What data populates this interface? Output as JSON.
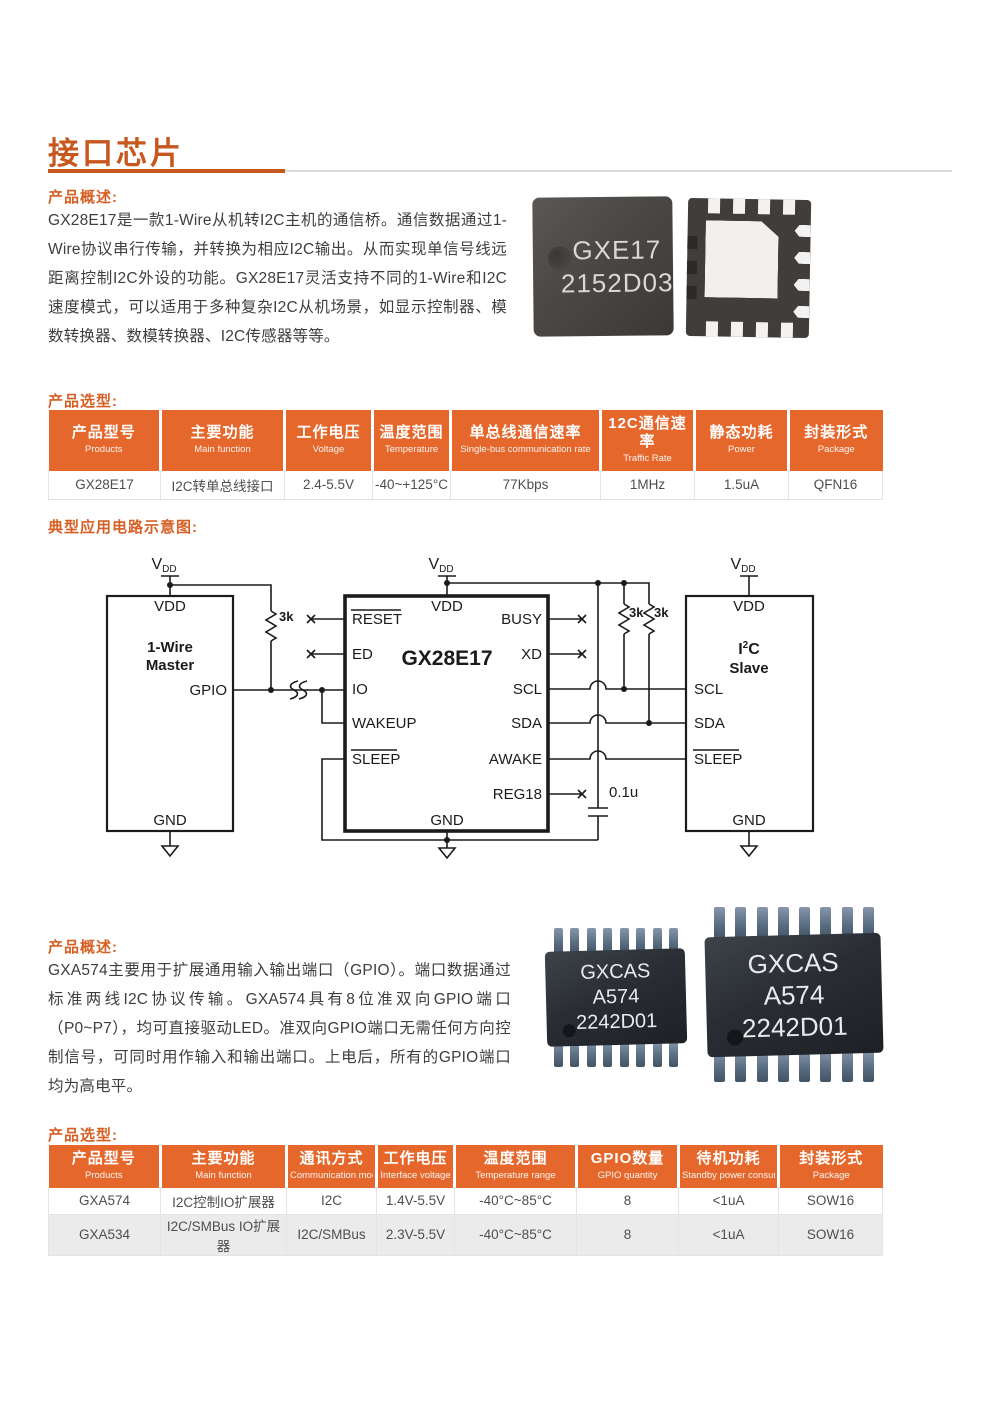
{
  "page": {
    "title": "接口芯片",
    "accent_color": "#c8571e",
    "table_header_color": "#e5672b"
  },
  "section1": {
    "overview_label": "产品概述:",
    "overview_text": "GX28E17是一款1-Wire从机转I2C主机的通信桥。通信数据通过1-Wire协议串行传输，并转换为相应I2C输出。从而实现单信号线远距离控制I2C外设的功能。GX28E17灵活支持不同的1-Wire和I2C速度模式，可以适用于多种复杂I2C从机场景，如显示控制器、模数转换器、数模转换器、I2C传感器等等。",
    "selection_label": "产品选型:",
    "chip_marking": {
      "line1": "GXE17",
      "line2": "2152D03"
    }
  },
  "table1": {
    "headers": [
      [
        "产品型号",
        "Products"
      ],
      [
        "主要功能",
        "Main function"
      ],
      [
        "工作电压",
        "Voltage"
      ],
      [
        "温度范围",
        "Temperature"
      ],
      [
        "单总线通信速率",
        "Single-bus communication rate"
      ],
      [
        "12C通信速率",
        "Traffic Rate"
      ],
      [
        "静态功耗",
        "Power"
      ],
      [
        "封装形式",
        "Package"
      ]
    ],
    "rows": [
      [
        "GX28E17",
        "I2C转单总线接口",
        "2.4-5.5V",
        "-40~+125°C",
        "77Kbps",
        "1MHz",
        "1.5uA",
        "QFN16"
      ]
    ]
  },
  "diagram": {
    "label": "典型应用电路示意图:",
    "vdd_symbol": {
      "main": "V",
      "sub": "DD"
    },
    "master": {
      "vdd": "VDD",
      "name1": "1-Wire",
      "name2": "Master",
      "gpio": "GPIO",
      "gnd": "GND"
    },
    "chip": {
      "name": "GX28E17",
      "vdd": "VDD",
      "gnd": "GND",
      "reset": "RESET",
      "ed": "ED",
      "io": "IO",
      "wakeup": "WAKEUP",
      "sleep": "SLEEP",
      "busy": "BUSY",
      "xd": "XD",
      "scl": "SCL",
      "sda": "SDA",
      "awake": "AWAKE",
      "reg18": "REG18"
    },
    "slave": {
      "vdd": "VDD",
      "name_i": "I",
      "name_sup": "2",
      "name_c": "C",
      "name2": "Slave",
      "scl": "SCL",
      "sda": "SDA",
      "sleep": "SLEEP",
      "gnd": "GND"
    },
    "r_left": "3k",
    "r_scl": "3k",
    "r_sda": "3k",
    "cap": "0.1u"
  },
  "section2": {
    "overview_label": "产品概述:",
    "overview_text": "GXA574主要用于扩展通用输入输出端口（GPIO）。端口数据通过标准两线I2C协议传输。GXA574具有8位准双向GPIO端口（P0~P7），均可直接驱动LED。准双向GPIO端口无需任何方向控制信号，可同时用作输入和输出端口。上电后，所有的GPIO端口均为高电平。",
    "selection_label": "产品选型:",
    "chip_marking": {
      "line1": "GXCAS",
      "line2": "A574",
      "line3": "2242D01"
    }
  },
  "table2": {
    "headers": [
      [
        "产品型号",
        "Products"
      ],
      [
        "主要功能",
        "Main function"
      ],
      [
        "通讯方式",
        "Communication mode"
      ],
      [
        "工作电压",
        "Interface voltage"
      ],
      [
        "温度范围",
        "Temperature range"
      ],
      [
        "GPIO数量",
        "GPIO quantity"
      ],
      [
        "待机功耗",
        "Standby power consumption"
      ],
      [
        "封装形式",
        "Package"
      ]
    ],
    "rows": [
      [
        "GXA574",
        "I2C控制IO扩展器",
        "I2C",
        "1.4V-5.5V",
        "-40°C~85°C",
        "8",
        "<1uA",
        "SOW16"
      ],
      [
        "GXA534",
        "I2C/SMBus IO扩展器",
        "I2C/SMBus",
        "2.3V-5.5V",
        "-40°C~85°C",
        "8",
        "<1uA",
        "SOW16"
      ]
    ]
  }
}
